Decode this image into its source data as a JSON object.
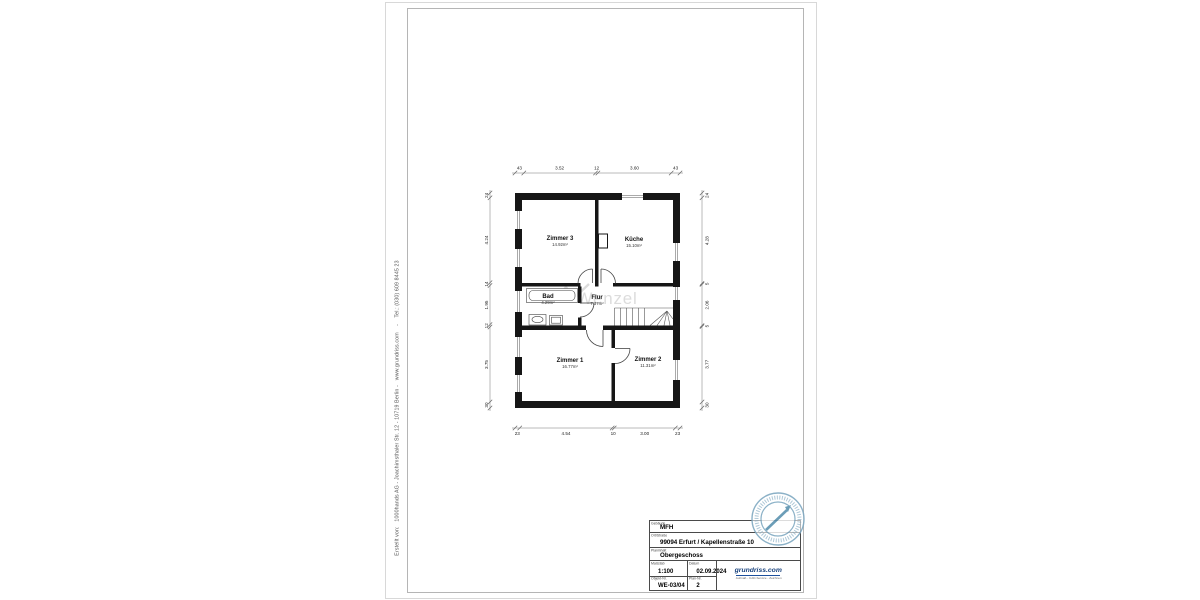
{
  "sheet": {
    "credit_line": "Erstellt von:   1000hands AG - Joachimsthaler Str. 12 - 10719 Berlin -   www.grundriss.com    -    Tel.: (030) 609 8445 23",
    "watermark": "Wenzel"
  },
  "floor_plan": {
    "rooms": [
      {
        "name": "Zimmer 3",
        "area": "14.92m²"
      },
      {
        "name": "Küche",
        "area": "15.10m²"
      },
      {
        "name": "Bad",
        "area": "4.29m²"
      },
      {
        "name": "Flur",
        "area": "7.37m²"
      },
      {
        "name": "Zimmer 1",
        "area": "16.77m²"
      },
      {
        "name": "Zimmer 2",
        "area": "11.31m²"
      }
    ],
    "dimensions_m": {
      "top": [
        "43",
        "3.52",
        "12",
        "3.60",
        "43"
      ],
      "bottom": [
        "23",
        "4.54",
        "10",
        "3.00",
        "23"
      ],
      "left": [
        "24",
        "4.24",
        "14",
        "1.95",
        "12",
        "3.75",
        "30"
      ],
      "right": [
        "24",
        "4.28",
        "5",
        "2.06",
        "5",
        "3.77",
        "30"
      ]
    }
  },
  "title_block": {
    "fields": {
      "gebaeude": {
        "label": "Gebäude",
        "value": "MFH"
      },
      "ort_strasse": {
        "label": "Ort/Straße",
        "value": "99094 Erfurt / Kapellenstraße 10"
      },
      "planinhalt": {
        "label": "Planinhalt",
        "value": "Obergeschoss"
      },
      "massstab": {
        "label": "Maßstab",
        "value": "1:100"
      },
      "datum": {
        "label": "Datum",
        "value": "02.09.2024"
      },
      "objekt_nr": {
        "label": "Objekt-Nr.",
        "value": "WE-03/04"
      },
      "plan_nr": {
        "label": "Plan-Nr.",
        "value": "2"
      }
    },
    "logo": {
      "text": "grundriss.com",
      "tagline": "Aufmaß - CAD-Service - Zeichnen"
    }
  },
  "colors": {
    "wall": "#161616",
    "stamp_blue": "#7fa9c2",
    "logo_blue": "#16407c",
    "frame_gray": "#b5b5b5"
  }
}
